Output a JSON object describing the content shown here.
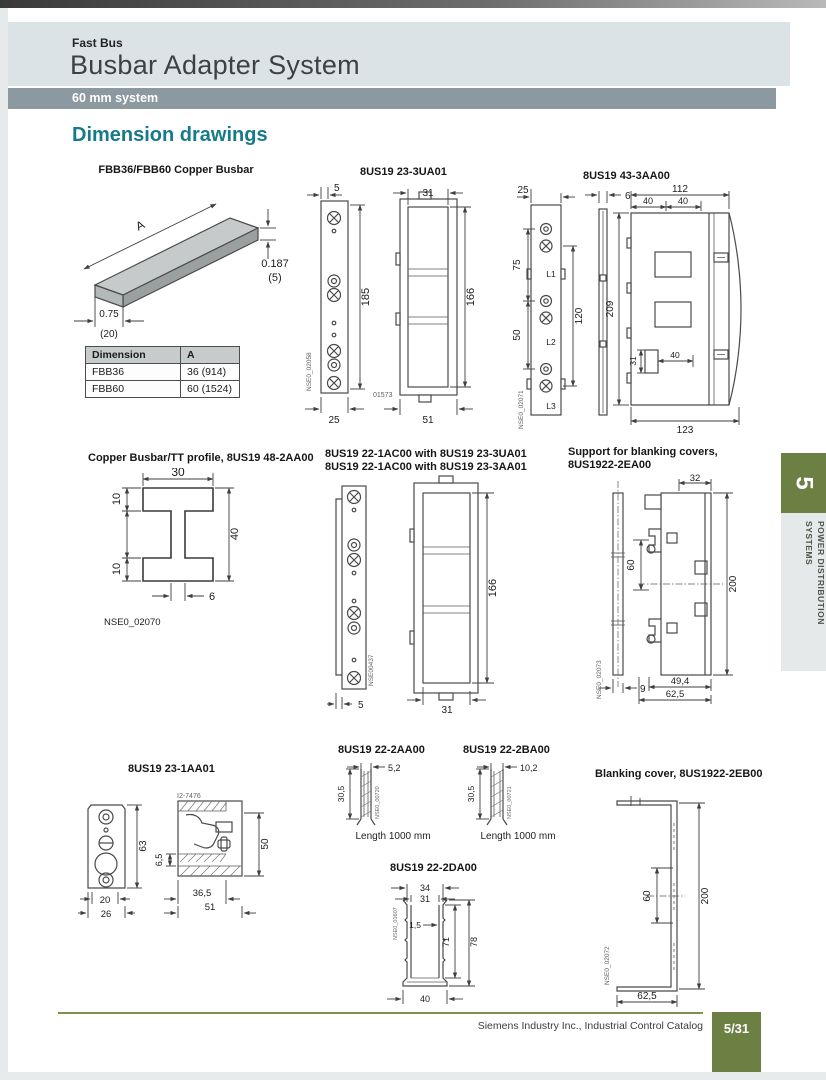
{
  "header": {
    "eyebrow": "Fast Bus",
    "title": "Busbar Adapter System",
    "band": "60 mm system"
  },
  "section_title": "Dimension drawings",
  "colors": {
    "accent_teal": "#177a8a",
    "band_gray": "#8d99a1",
    "header_bg": "#dce3e6",
    "tab_green": "#6d8044",
    "footer_line_olive": "#7d9153"
  },
  "drawings": {
    "busbar": {
      "title": "FBB36/FBB60 Copper Busbar",
      "dim_length": "A",
      "dim_thickness_in": "0.187",
      "dim_thickness_mm": "(5)",
      "dim_width_in": "0.75",
      "dim_width_mm": "(20)",
      "table": {
        "col_dimension": "Dimension",
        "col_a": "A",
        "rows": [
          {
            "dimension": "FBB36",
            "a": "36 (914)"
          },
          {
            "dimension": "FBB60",
            "a": "60 (1524)"
          }
        ]
      }
    },
    "adapter_23_3ua01": {
      "title": "8US19 23-3UA01",
      "dim_5": "5",
      "dim_185": "185",
      "dim_25": "25",
      "dim_31": "31",
      "dim_166": "166",
      "dim_51": "51",
      "ref_nse": "NSE0_02058",
      "ref_num": "01573"
    },
    "adapter_43_3aa00": {
      "title": "8US19 43-3AA00",
      "dim_25": "25",
      "dim_6": "6",
      "dim_112": "112",
      "dim_40a": "40",
      "dim_40b": "40",
      "dim_75": "75",
      "dim_50": "50",
      "dim_120": "120",
      "dim_209": "209",
      "dim_31": "31",
      "dim_40c": "40",
      "dim_123": "123",
      "label_l1": "L1",
      "label_l2": "L2",
      "label_l3": "L3",
      "ref_nse": "NSE0_02071"
    },
    "tt_profile": {
      "title": "Copper Busbar/TT profile, 8US19 48-2AA00",
      "dim_30": "30",
      "dim_10a": "10",
      "dim_40": "40",
      "dim_10b": "10",
      "dim_6": "6",
      "ref_nse": "NSE0_02070"
    },
    "adapter_22_1ac00": {
      "title_line1": "8US19 22-1AC00 with 8US19 23-3UA01",
      "title_line2": "8US19 22-1AC00 with 8US19 23-3AA01",
      "dim_5": "5",
      "dim_166": "166",
      "dim_31": "31",
      "ref_nse": "NSE00437"
    },
    "support_blanking": {
      "title_line1": "Support for blanking covers,",
      "title_line2": "8US1922-2EA00",
      "dim_32": "32",
      "dim_60": "60",
      "dim_200": "200",
      "dim_9": "9",
      "dim_49_4": "49,4",
      "dim_62_5": "62,5",
      "ref_nse": "NSE0_02073"
    },
    "adapter_23_1aa01": {
      "title": "8US19 23-1AA01",
      "ref_top": "I2-7476",
      "dim_63": "63",
      "dim_20": "20",
      "dim_26": "26",
      "dim_6_5": "6,5",
      "dim_50": "50",
      "dim_36_5": "36,5",
      "dim_51": "51"
    },
    "profile_22_2aa00": {
      "title": "8US19 22-2AA00",
      "dim_5_2": "5,2",
      "dim_30_5": "30,5",
      "length_note": "Length 1000 mm",
      "ref_nse": "NSE0_00720"
    },
    "profile_22_2ba00": {
      "title": "8US19 22-2BA00",
      "dim_10_2": "10,2",
      "dim_30_5": "30,5",
      "length_note": "Length 1000 mm",
      "ref_nse": "NSE0_00721"
    },
    "profile_22_2da00": {
      "title": "8US19 22-2DA00",
      "dim_34": "34",
      "dim_31": "31",
      "dim_1_5": "1,5",
      "dim_71": "71",
      "dim_78": "78",
      "dim_40": "40",
      "ref_nse": "NSE0_01607"
    },
    "blanking_cover": {
      "title": "Blanking cover, 8US1922-2EB00",
      "dim_60": "60",
      "dim_200": "200",
      "dim_62_5": "62,5",
      "ref_nse": "NSE0_02072"
    }
  },
  "sidebar_tab": {
    "number": "5",
    "label_line1": "POWER DISTRIBUTION",
    "label_line2": "SYSTEMS"
  },
  "footer": {
    "catalog": "Siemens Industry Inc., Industrial Control Catalog",
    "page": "5/31"
  }
}
